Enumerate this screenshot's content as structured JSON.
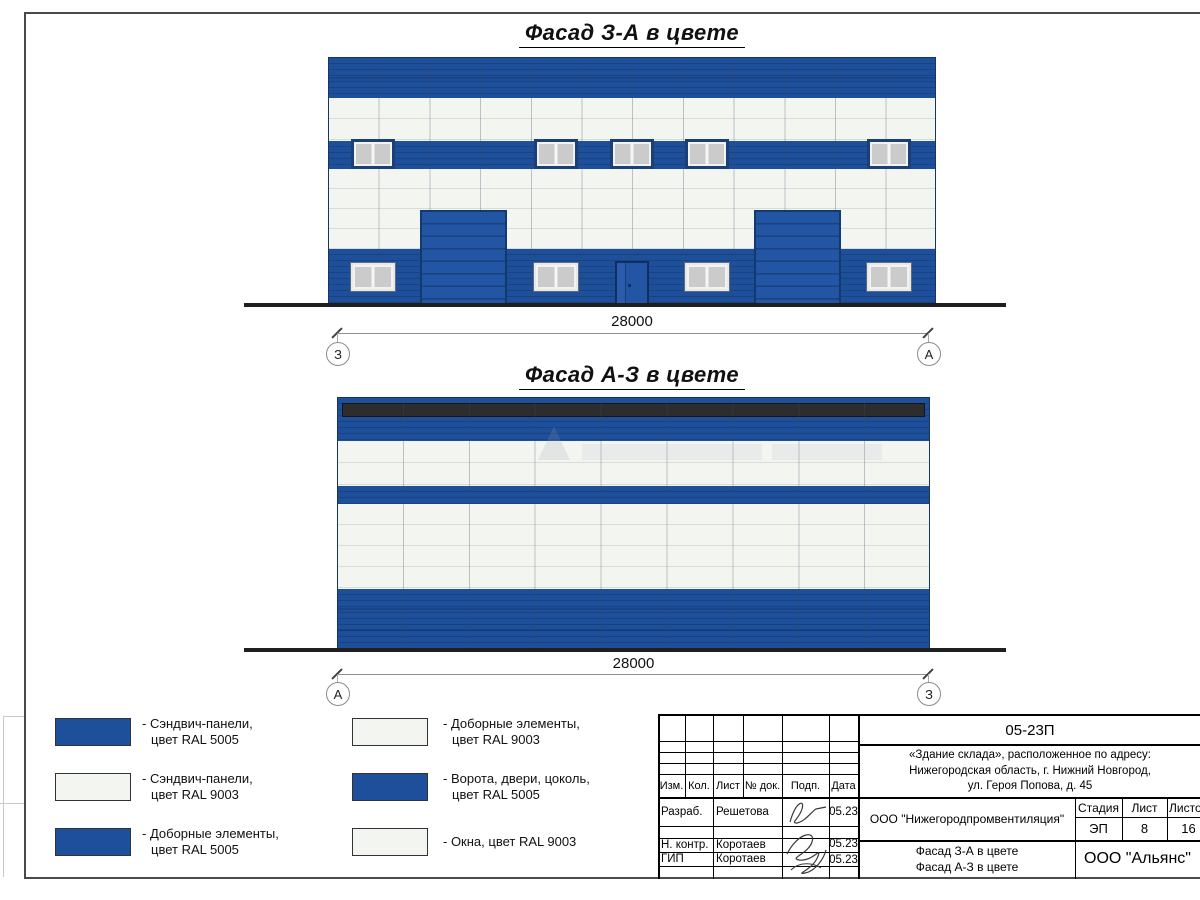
{
  "titles": {
    "facade1": "Фасад З-А в цвете",
    "facade2": "Фасад А-З в цвете"
  },
  "facade1": {
    "dimension": "28000",
    "axis_left": "З",
    "axis_right": "А"
  },
  "facade2": {
    "dimension": "28000",
    "axis_left": "А",
    "axis_right": "З"
  },
  "legend": {
    "items": [
      {
        "swatch": "blue",
        "line1": "- Сэндвич-панели,",
        "line2": "цвет RAL 5005"
      },
      {
        "swatch": "white",
        "line1": "- Сэндвич-панели,",
        "line2": "цвет RAL 9003"
      },
      {
        "swatch": "blue",
        "line1": "- Доборные элементы,",
        "line2": "цвет RAL 5005"
      },
      {
        "swatch": "white",
        "line1": "- Доборные элементы,",
        "line2": "цвет RAL 9003"
      },
      {
        "swatch": "blue",
        "line1": "- Ворота, двери, цоколь,",
        "line2": "цвет RAL 5005"
      },
      {
        "swatch": "white",
        "line1": "- Окна, цвет RAL 9003",
        "line2": ""
      }
    ]
  },
  "title_block": {
    "doc_number": "05-23П",
    "project_line1": "«Здание склада», расположенное по адресу:",
    "project_line2": "Нижегородская область, г. Нижний Новгород,",
    "project_line3": "ул. Героя Попова, д. 45",
    "col_izm": "Изм.",
    "col_kol": "Кол.",
    "col_list": "Лист",
    "col_doc": "№ док.",
    "col_podp": "Подп.",
    "col_data": "Дата",
    "row1_role": "Разраб.",
    "row1_name": "Решетова",
    "row1_date": "05.23",
    "row2_role": "Н. контр.",
    "row2_name": "Коротаев",
    "row2_date": "05.23",
    "row3_role": "ГИП",
    "row3_name": "Коротаев",
    "row3_date": "05.23",
    "company": "ООО \"Нижегородпромвентиляция\"",
    "stage_label": "Стадия",
    "sheet_label": "Лист",
    "sheets_label": "Листов",
    "stage_value": "ЭП",
    "sheet_value": "8",
    "sheets_value": "16",
    "sheet_title_line1": "Фасад З-А в цвете",
    "sheet_title_line2": "Фасад А-З в цвете",
    "org": "ООО \"Альянс\""
  },
  "colors": {
    "ral5005_blue": "#1e4f9a",
    "ral9003_white": "#f3f5f1",
    "parapet_dark": "#2d2d2d"
  }
}
